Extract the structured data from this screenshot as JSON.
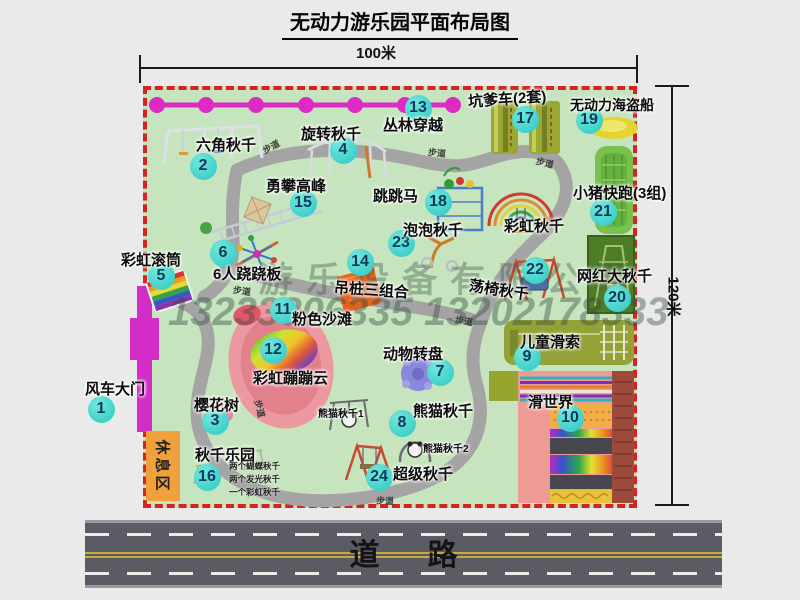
{
  "title": "无动力游乐园平面布局图",
  "dimensions": {
    "width": "100米",
    "height": "120米"
  },
  "road": {
    "label": "道路"
  },
  "watermark": {
    "company": "游乐设备有限公司",
    "phone": "13233806335 13202178333"
  },
  "map": {
    "rest_area": "休息区",
    "path_label": "步道",
    "path_labels": [
      {
        "x": 262,
        "y": 140,
        "rot": -28
      },
      {
        "x": 428,
        "y": 146,
        "rot": 6
      },
      {
        "x": 536,
        "y": 156,
        "rot": 14
      },
      {
        "x": 233,
        "y": 284,
        "rot": 8
      },
      {
        "x": 251,
        "y": 402,
        "rot": 76
      },
      {
        "x": 376,
        "y": 494,
        "rot": 2
      },
      {
        "x": 455,
        "y": 314,
        "rot": 10
      }
    ],
    "markers": [
      {
        "num": "1",
        "label": "风车大门",
        "cx": 101,
        "cy": 409,
        "lx": 85,
        "ly": 378
      },
      {
        "num": "2",
        "label": "六角秋千",
        "cx": 203,
        "cy": 166,
        "lx": 196,
        "ly": 134
      },
      {
        "num": "3",
        "label": "樱花树",
        "cx": 215,
        "cy": 421,
        "lx": 194,
        "ly": 394
      },
      {
        "num": "4",
        "label": "旋转秋千",
        "cx": 343,
        "cy": 150,
        "lx": 301,
        "ly": 123
      },
      {
        "num": "5",
        "label": "彩虹滚筒",
        "cx": 161,
        "cy": 276,
        "lx": 121,
        "ly": 249
      },
      {
        "num": "6",
        "label": "6人跷跷板",
        "cx": 223,
        "cy": 253,
        "lx": 213,
        "ly": 263
      },
      {
        "num": "7",
        "label": "动物转盘",
        "cx": 440,
        "cy": 372,
        "lx": 383,
        "ly": 343
      },
      {
        "num": "8",
        "label": "熊猫秋千",
        "cx": 402,
        "cy": 423,
        "lx": 413,
        "ly": 400
      },
      {
        "num": "9",
        "label": "儿童滑索",
        "cx": 527,
        "cy": 357,
        "lx": 520,
        "ly": 331
      },
      {
        "num": "10",
        "label": "滑世界",
        "cx": 570,
        "cy": 418,
        "lx": 528,
        "ly": 391
      },
      {
        "num": "11",
        "label": "粉色沙滩",
        "cx": 283,
        "cy": 310,
        "lx": 292,
        "ly": 308
      },
      {
        "num": "12",
        "label": "彩虹蹦蹦云",
        "cx": 273,
        "cy": 350,
        "lx": 253,
        "ly": 367
      },
      {
        "num": "13",
        "label": "丛林穿越",
        "cx": 418,
        "cy": 108,
        "lx": 383,
        "ly": 114
      },
      {
        "num": "14",
        "label": "吊桩三组合",
        "cx": 360,
        "cy": 262,
        "lx": 334,
        "ly": 279,
        "rot": 4
      },
      {
        "num": "15",
        "label": "勇攀高峰",
        "cx": 303,
        "cy": 203,
        "lx": 266,
        "ly": 175
      },
      {
        "num": "16",
        "label": "秋千乐园",
        "cx": 207,
        "cy": 477,
        "lx": 195,
        "ly": 444
      },
      {
        "num": "17",
        "label": "坑爹车(2套)",
        "cx": 525,
        "cy": 119,
        "lx": 468,
        "ly": 88,
        "rot": -4
      },
      {
        "num": "18",
        "label": "跳跳马",
        "cx": 438,
        "cy": 202,
        "lx": 373,
        "ly": 185
      },
      {
        "num": "19",
        "label": "无动力海盗船",
        "cx": 589,
        "cy": 120,
        "lx": 570,
        "ly": 95,
        "size": 14
      },
      {
        "num": "20",
        "label": "网红大秋千",
        "cx": 617,
        "cy": 298,
        "lx": 577,
        "ly": 265
      },
      {
        "num": "21",
        "label": "小猪快跑(3组)",
        "cx": 603,
        "cy": 212,
        "lx": 573,
        "ly": 182
      },
      {
        "num": "22",
        "label": "荡椅秋千",
        "cx": 535,
        "cy": 270,
        "lx": 469,
        "ly": 279,
        "rot": 9
      },
      {
        "num": "23",
        "label": "泡泡秋千",
        "cx": 401,
        "cy": 243,
        "lx": 403,
        "ly": 219
      },
      {
        "num": "24",
        "label": "超级秋千",
        "cx": 379,
        "cy": 477,
        "lx": 393,
        "ly": 463
      }
    ],
    "extra_labels": [
      {
        "text": "彩虹秋千",
        "x": 504,
        "y": 215,
        "size": 15
      },
      {
        "text": "熊猫秋千1",
        "x": 318,
        "y": 405,
        "size": 10
      },
      {
        "text": "熊猫秋千2",
        "x": 423,
        "y": 440,
        "size": 10
      }
    ],
    "swing_park_notes": [
      "两个蝴蝶秋千",
      "两个发光秋千",
      "一个彩虹秋千"
    ]
  }
}
